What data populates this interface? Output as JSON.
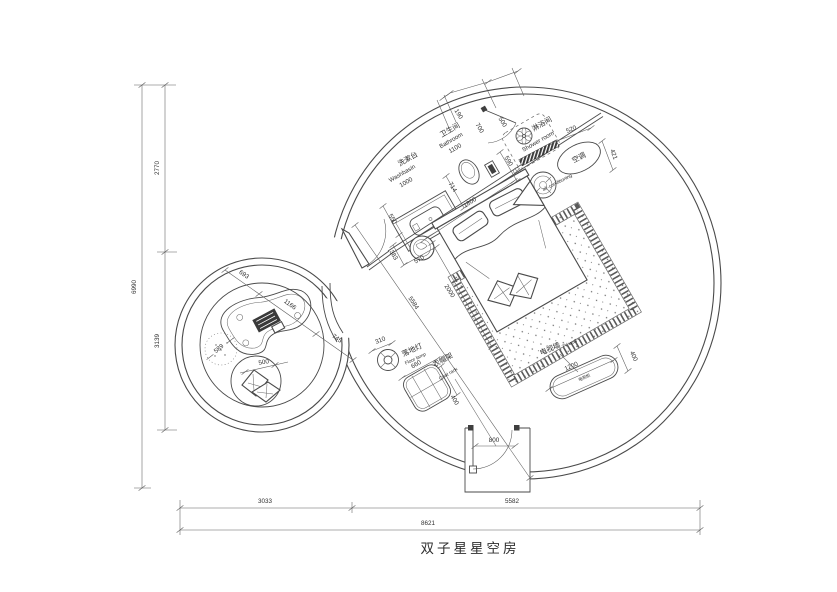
{
  "title": "双子星星空房",
  "ink_color": "#4a4a4a",
  "areas": {
    "washbasin": {
      "cn": "洗漱台",
      "en": "Washbasin",
      "width": "1000",
      "depth": "550"
    },
    "bathroom": {
      "cn": "卫生间",
      "en": "Bathroom",
      "width": "1100",
      "gap": "190",
      "toilet_bay": "700",
      "door_bay": "500",
      "shower_bay": "590",
      "fixture": "714",
      "wall": "1800"
    },
    "shower": {
      "cn": "淋浴间",
      "en": "Shower room"
    },
    "ac": {
      "cn": "空调",
      "en": "air-conditioning",
      "width": "520",
      "depth": "421"
    },
    "bed": {
      "side": "383",
      "side2": "570",
      "length": "2000",
      "diagonal": "5584"
    },
    "tv": {
      "cn": "电视墙",
      "en": "TV wall",
      "cabinet": "电视柜",
      "width": "1200",
      "depth": "400"
    },
    "lamp": {
      "cn": "落地灯",
      "en": "Floor lamp",
      "offset": "310"
    },
    "coat_rack": {
      "cn": "衣帽架",
      "en": "Coat rack",
      "width": "660",
      "depth": "400"
    },
    "entry": {
      "width": "800"
    },
    "pod": {
      "seg1": "693",
      "seg2": "1166",
      "seg3": "745",
      "rug": "589",
      "seat": "500"
    }
  },
  "overall": {
    "left_top": "2770",
    "left_bottom": "3139",
    "left_total": "6990",
    "bottom_left": "3033",
    "bottom_right": "5582",
    "bottom_total": "8621"
  }
}
